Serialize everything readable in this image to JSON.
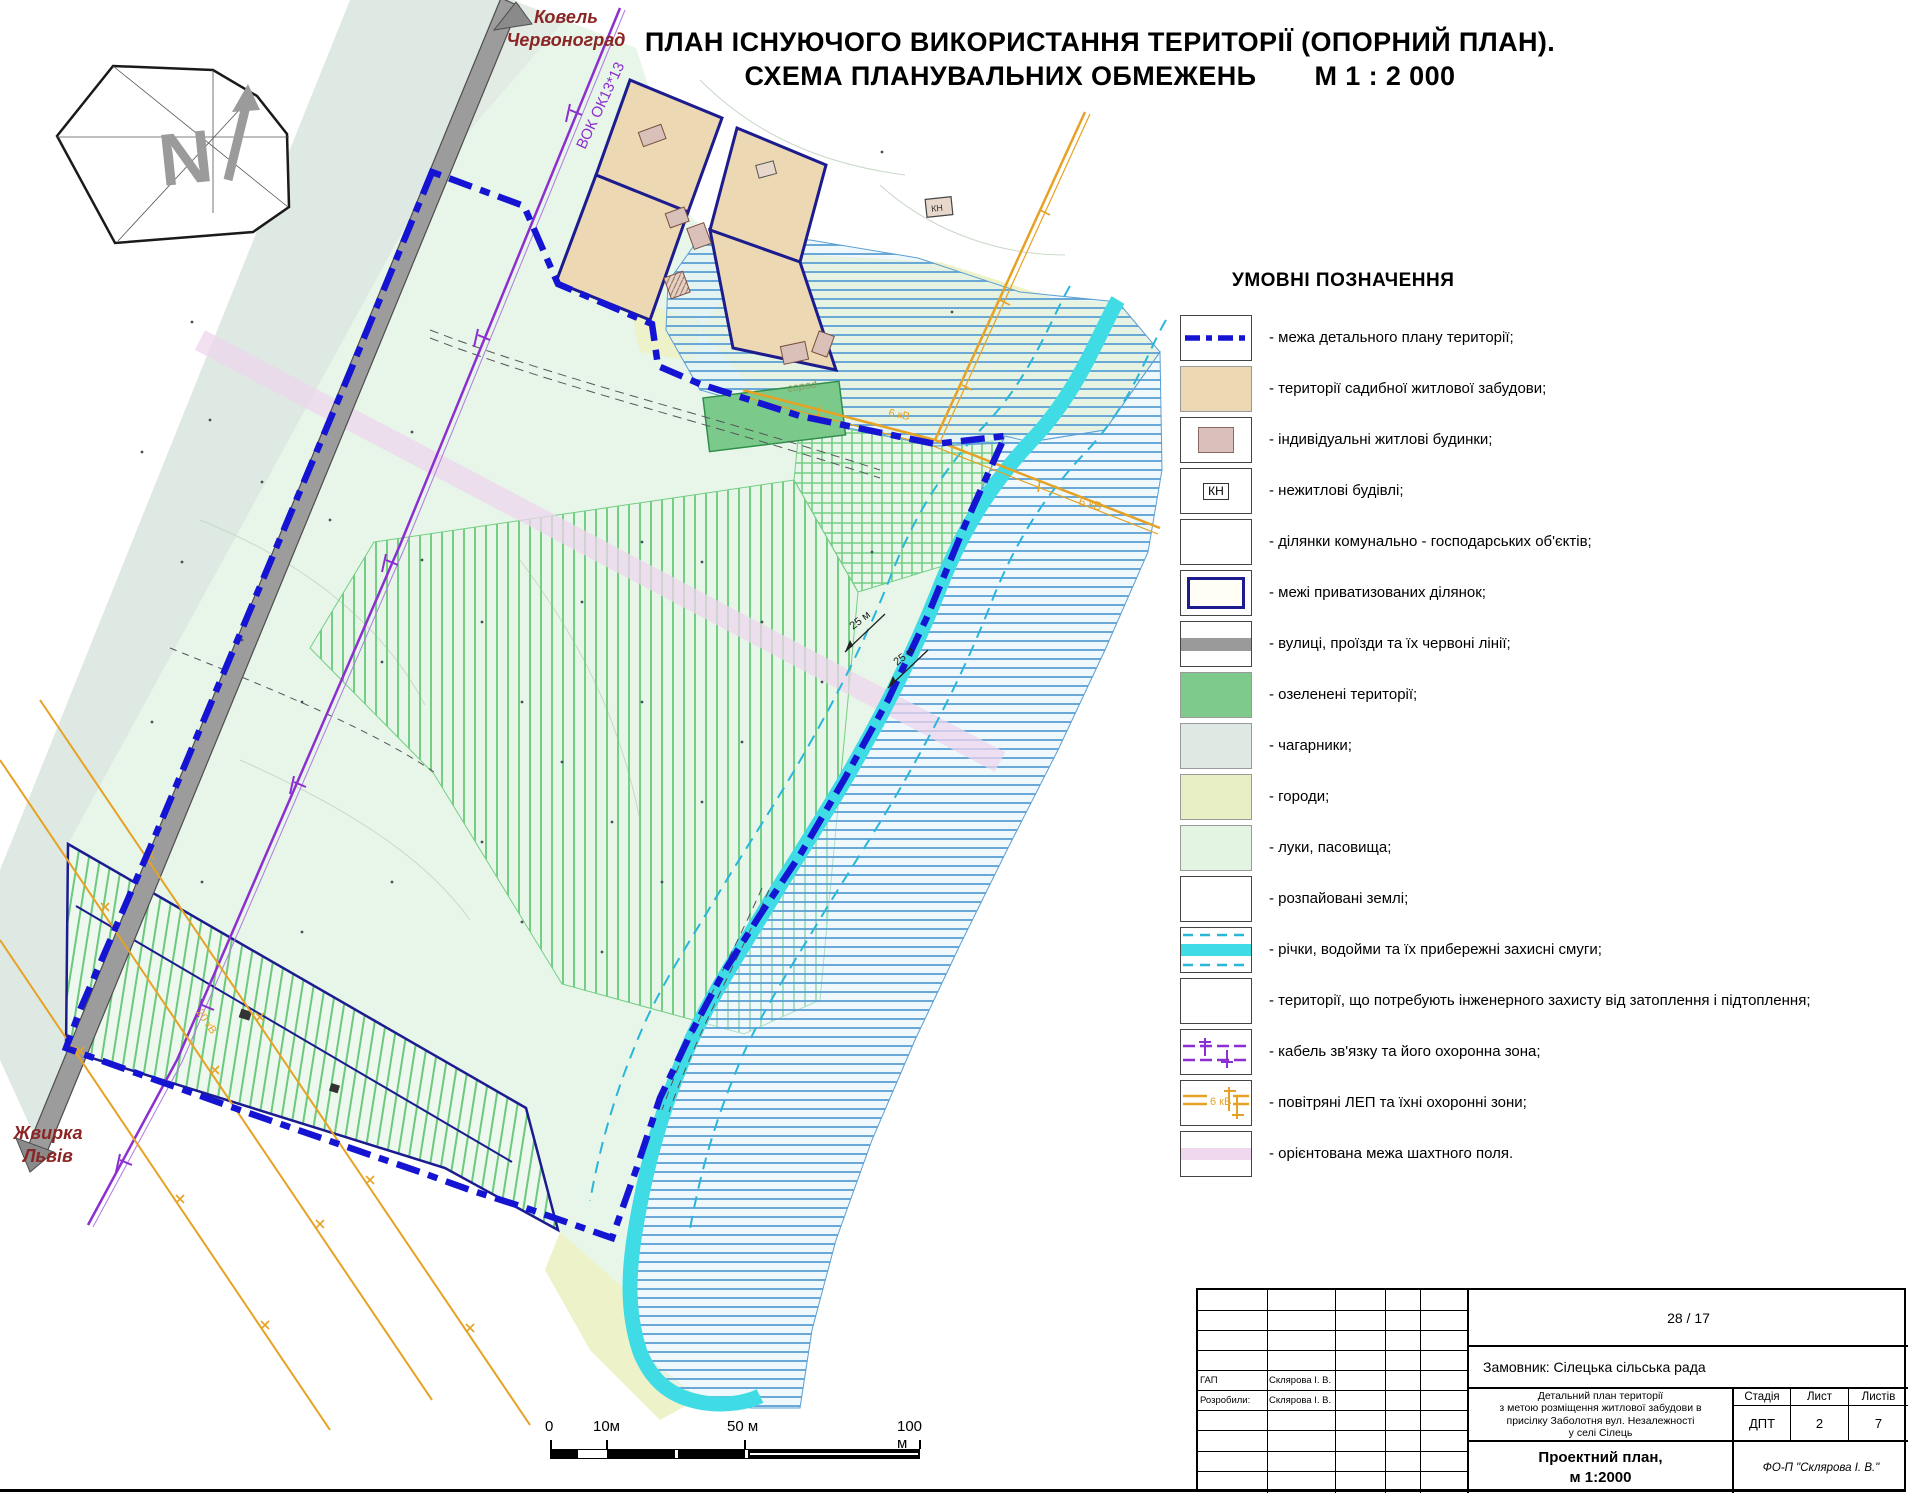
{
  "title": {
    "line1": "ПЛАН ІСНУЮЧОГО ВИКОРИСТАННЯ ТЕРИТОРІЇ (ОПОРНИЙ ПЛАН).",
    "line2": "СХЕМА ПЛАНУВАЛЬНИХ ОБМЕЖЕНЬ",
    "scale": "М 1 : 2 000"
  },
  "compass": {
    "letter": "N"
  },
  "map_labels": {
    "road_north_1": "Ковель",
    "road_north_2": "Червоноград",
    "road_south_1": "Жвирка",
    "road_south_2": "Львів",
    "cable": "ВОК ОК13*13",
    "kv6": "6 кВ",
    "kv20": "20 кВ",
    "buffer25": "25 м",
    "garden": "город",
    "kn": "КН"
  },
  "legend": {
    "heading": "УМОВНІ ПОЗНАЧЕННЯ",
    "kn": "КН",
    "kv6": "6 кВ",
    "items": [
      {
        "label": "- межа детального плану території;"
      },
      {
        "label": "- території садибної житлової забудови;"
      },
      {
        "label": "- індивідуальні житлові будинки;"
      },
      {
        "label": "- нежитлові будівлі;"
      },
      {
        "label": "- ділянки комунально - господарських об'єктів;"
      },
      {
        "label": "- межі приватизованих ділянок;"
      },
      {
        "label": "- вулиці, проїзди та їх червоні лінії;"
      },
      {
        "label": "- озеленені території;"
      },
      {
        "label": "- чагарники;"
      },
      {
        "label": "- городи;"
      },
      {
        "label": "- луки, пасовища;"
      },
      {
        "label": "- розпайовані землі;"
      },
      {
        "label": "- річки, водойми та їх прибережні захисні смуги;"
      },
      {
        "label": "- території, що потребують інженерного захисту від затоплення і підтоплення;"
      },
      {
        "label": "- кабель зв'язку та його охоронна зона;"
      },
      {
        "label": "- повітряні ЛЕП та їхні охоронні зони;"
      },
      {
        "label": "- орієнтована межа шахтного поля."
      }
    ]
  },
  "scalebar": {
    "t0": "0",
    "t10": "10м",
    "t50": "50 м",
    "t100": "100 м"
  },
  "titleblock": {
    "number": "28 / 17",
    "client": "Замовник: Сілецька сільська рада",
    "project_1": "Детальний план території",
    "project_2": "з метою розміщення житлової забудови в",
    "project_3": "присілку Заболотня вул. Незалежності",
    "project_4": "у селі Сілець",
    "stage_label": "Стадія",
    "sheet_label": "Лист",
    "sheets_label": "Листів",
    "stage": "ДПТ",
    "sheet": "2",
    "sheets": "7",
    "doc_1": "Проектний план,",
    "doc_2": "м 1:2000",
    "company": "ФО-П \"Склярова І. В.\"",
    "role_1": "ГАП",
    "role_2": "Розробили:",
    "name_1": "Склярова І. В.",
    "name_2": "Склярова І. В."
  }
}
